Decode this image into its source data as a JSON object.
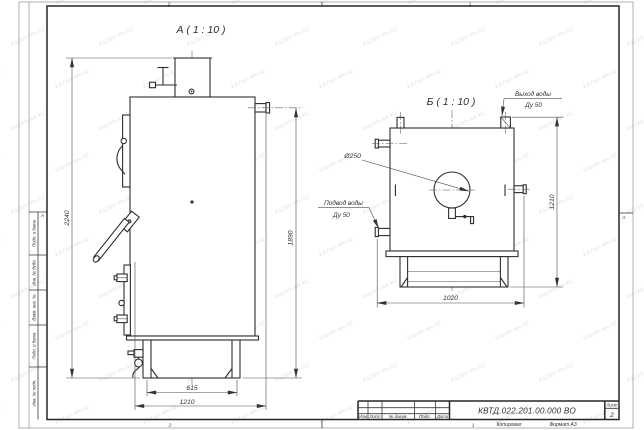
{
  "watermark": {
    "text": "kazan-wv.kz"
  },
  "views": {
    "a": {
      "label": "А ( 1 : 10 )",
      "dim_total_height": "2240",
      "dim_body_height": "1890",
      "dim_base": "615",
      "dim_depth": "1210"
    },
    "b": {
      "label": "Б ( 1 : 10 )",
      "dim_height": "1210",
      "dim_width": "1020",
      "flue_diameter": "Ø250",
      "outlet": {
        "line1": "Выход воды",
        "line2": "Ду 50"
      },
      "inlet": {
        "line1": "Подвод воды",
        "line2": "Ду 50"
      }
    }
  },
  "frame": {
    "zones": {
      "top_left": "2",
      "top_right": "1",
      "bottom_left": "2",
      "bottom_right": "1",
      "side_left": "А",
      "side_right": "А"
    },
    "margin_cells": [
      "Подп. и дата",
      "Инв. № дубл.",
      "Взам. инв. №",
      "Подп. и дата",
      "Инв. № подл."
    ]
  },
  "title_block": {
    "doc_number": "КВТД.022.201.00.000 ВО",
    "columns": [
      "Изм",
      "Лист",
      "№ докум.",
      "Подп.",
      "Дата"
    ],
    "sheet_label": "Лист",
    "sheet_number": "2",
    "footer": {
      "copied": "Копировал",
      "format": "Формат А3"
    }
  },
  "colors": {
    "line": "#2e2e2e",
    "thin_line": "#4a4d52",
    "background": "#ffffff",
    "watermark": "#c3c9d4"
  }
}
